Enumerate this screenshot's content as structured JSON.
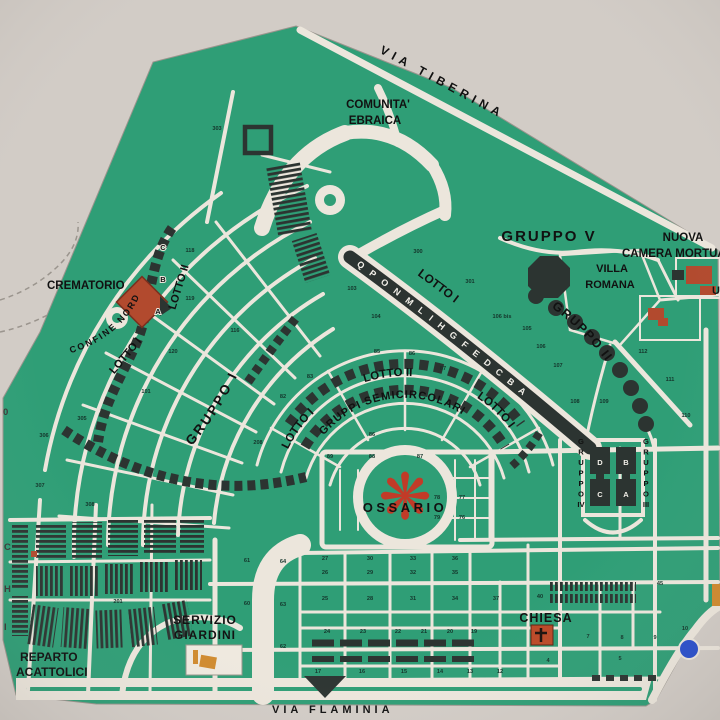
{
  "map": {
    "title": "Cemetery plan",
    "colors": {
      "background": "#d2ccc6",
      "map_green": "#2f9e76",
      "road": "#ece6dc",
      "dark": "#2c3431",
      "brick_red": "#b24a2e",
      "bright_red": "#c23b28",
      "orange": "#d08a2f",
      "blue": "#2a50cc",
      "text": "#111111"
    },
    "labels": {
      "via_tiberina": "VIA TIBERINA",
      "via_flaminia": "VIA FLAMINIA",
      "comunita_line1": "COMUNITA'",
      "comunita_line2": "EBRAICA",
      "gruppo_v": "GRUPPO V",
      "nuova": "NUOVA",
      "camera": "CAMERA MORTUAR",
      "villa": "VILLA",
      "romana": "ROMANA",
      "u_partial": "U",
      "crematorio": "CREMATORIO",
      "confine_nord": "CONFINE NORD",
      "gruppo_i": "GRUPPO I",
      "gruppo_ii": "GRUPPO II",
      "lotto_i": "LOTTO I",
      "lotto_ii": "LOTTO II",
      "gruppi_semicircolari": "GRUPPI SEMICIRCOLARI",
      "ossario": "OSSARIO",
      "chiesa": "CHIESA",
      "servizio_line1": "SERVIZIO",
      "servizio_line2": "GIARDINI",
      "reparto_line1": "REPARTO",
      "reparto_line2": "ACATTOLICI",
      "colonnade_letters": "Q P O N M L I H G F E D C B A"
    },
    "icons": {
      "ossario_pinwheel": "❋"
    },
    "plot_numbers": [
      {
        "x": 217,
        "y": 130,
        "n": "303"
      },
      {
        "x": 418,
        "y": 253,
        "n": "300"
      },
      {
        "x": 470,
        "y": 283,
        "n": "301"
      },
      {
        "x": 352,
        "y": 290,
        "n": "103"
      },
      {
        "x": 376,
        "y": 318,
        "n": "104"
      },
      {
        "x": 502,
        "y": 318,
        "n": "106 bis"
      },
      {
        "x": 527,
        "y": 330,
        "n": "105"
      },
      {
        "x": 541,
        "y": 348,
        "n": "106"
      },
      {
        "x": 558,
        "y": 367,
        "n": "107"
      },
      {
        "x": 575,
        "y": 403,
        "n": "108"
      },
      {
        "x": 604,
        "y": 403,
        "n": "109"
      },
      {
        "x": 643,
        "y": 353,
        "n": "112"
      },
      {
        "x": 670,
        "y": 381,
        "n": "111"
      },
      {
        "x": 686,
        "y": 417,
        "n": "110"
      },
      {
        "x": 190,
        "y": 252,
        "n": "118"
      },
      {
        "x": 190,
        "y": 300,
        "n": "119"
      },
      {
        "x": 173,
        "y": 353,
        "n": "120"
      },
      {
        "x": 146,
        "y": 393,
        "n": "101"
      },
      {
        "x": 235,
        "y": 332,
        "n": "116"
      },
      {
        "x": 258,
        "y": 444,
        "n": "208"
      },
      {
        "x": 310,
        "y": 378,
        "n": "83"
      },
      {
        "x": 283,
        "y": 398,
        "n": "82"
      },
      {
        "x": 377,
        "y": 353,
        "n": "85"
      },
      {
        "x": 412,
        "y": 355,
        "n": "86"
      },
      {
        "x": 443,
        "y": 370,
        "n": "87"
      },
      {
        "x": 330,
        "y": 458,
        "n": "89"
      },
      {
        "x": 372,
        "y": 458,
        "n": "88"
      },
      {
        "x": 420,
        "y": 458,
        "n": "87"
      },
      {
        "x": 372,
        "y": 436,
        "n": "86"
      },
      {
        "x": 437,
        "y": 499,
        "n": "78"
      },
      {
        "x": 462,
        "y": 499,
        "n": "77"
      },
      {
        "x": 437,
        "y": 519,
        "n": "79"
      },
      {
        "x": 462,
        "y": 519,
        "n": "76"
      },
      {
        "x": 82,
        "y": 420,
        "n": "305"
      },
      {
        "x": 44,
        "y": 437,
        "n": "306"
      },
      {
        "x": 40,
        "y": 487,
        "n": "307"
      },
      {
        "x": 90,
        "y": 506,
        "n": "308"
      },
      {
        "x": 118,
        "y": 603,
        "n": "201"
      },
      {
        "x": 247,
        "y": 562,
        "n": "61"
      },
      {
        "x": 283,
        "y": 563,
        "n": "64"
      },
      {
        "x": 247,
        "y": 605,
        "n": "60"
      },
      {
        "x": 283,
        "y": 606,
        "n": "63"
      },
      {
        "x": 283,
        "y": 648,
        "n": "62"
      },
      {
        "x": 325,
        "y": 560,
        "n": "27"
      },
      {
        "x": 370,
        "y": 560,
        "n": "30"
      },
      {
        "x": 413,
        "y": 560,
        "n": "33"
      },
      {
        "x": 455,
        "y": 560,
        "n": "36"
      },
      {
        "x": 325,
        "y": 574,
        "n": "26"
      },
      {
        "x": 370,
        "y": 574,
        "n": "29"
      },
      {
        "x": 413,
        "y": 574,
        "n": "32"
      },
      {
        "x": 455,
        "y": 574,
        "n": "35"
      },
      {
        "x": 325,
        "y": 600,
        "n": "25"
      },
      {
        "x": 370,
        "y": 600,
        "n": "28"
      },
      {
        "x": 413,
        "y": 600,
        "n": "31"
      },
      {
        "x": 455,
        "y": 600,
        "n": "34"
      },
      {
        "x": 327,
        "y": 633,
        "n": "24"
      },
      {
        "x": 363,
        "y": 633,
        "n": "23"
      },
      {
        "x": 398,
        "y": 633,
        "n": "22"
      },
      {
        "x": 424,
        "y": 633,
        "n": "21"
      },
      {
        "x": 450,
        "y": 633,
        "n": "20"
      },
      {
        "x": 474,
        "y": 633,
        "n": "19"
      },
      {
        "x": 318,
        "y": 673,
        "n": "17"
      },
      {
        "x": 362,
        "y": 673,
        "n": "16"
      },
      {
        "x": 404,
        "y": 673,
        "n": "15"
      },
      {
        "x": 440,
        "y": 673,
        "n": "14"
      },
      {
        "x": 470,
        "y": 673,
        "n": "13"
      },
      {
        "x": 500,
        "y": 673,
        "n": "12"
      },
      {
        "x": 496,
        "y": 600,
        "n": "37"
      },
      {
        "x": 540,
        "y": 598,
        "n": "40"
      },
      {
        "x": 660,
        "y": 585,
        "n": "45"
      },
      {
        "x": 588,
        "y": 638,
        "n": "7"
      },
      {
        "x": 622,
        "y": 639,
        "n": "8"
      },
      {
        "x": 655,
        "y": 639,
        "n": "9"
      },
      {
        "x": 685,
        "y": 630,
        "n": "10"
      },
      {
        "x": 620,
        "y": 660,
        "n": "5"
      },
      {
        "x": 548,
        "y": 662,
        "n": "4"
      }
    ],
    "block_letters": [
      {
        "x": 163,
        "y": 250,
        "ch": "C",
        "light": false
      },
      {
        "x": 163,
        "y": 282,
        "ch": "B",
        "light": false
      },
      {
        "x": 158,
        "y": 314,
        "ch": "A",
        "light": false
      },
      {
        "x": 600,
        "y": 465,
        "ch": "D",
        "light": true
      },
      {
        "x": 626,
        "y": 465,
        "ch": "B",
        "light": true
      },
      {
        "x": 600,
        "y": 497,
        "ch": "C",
        "light": true
      },
      {
        "x": 626,
        "y": 497,
        "ch": "A",
        "light": true
      }
    ],
    "edge_letters": [
      {
        "x": 3,
        "y": 415,
        "ch": "0"
      },
      {
        "x": 4,
        "y": 550,
        "ch": "C"
      },
      {
        "x": 4,
        "y": 592,
        "ch": "H"
      },
      {
        "x": 4,
        "y": 630,
        "ch": "I"
      }
    ],
    "vertical_labels": [
      {
        "x": 581,
        "y": 444,
        "dy": 10.5,
        "chars": [
          "G",
          "R",
          "U",
          "P",
          "P",
          "O",
          "IV"
        ]
      },
      {
        "x": 646,
        "y": 444,
        "dy": 10.5,
        "chars": [
          "G",
          "R",
          "U",
          "P",
          "P",
          "O",
          "III"
        ]
      }
    ]
  }
}
